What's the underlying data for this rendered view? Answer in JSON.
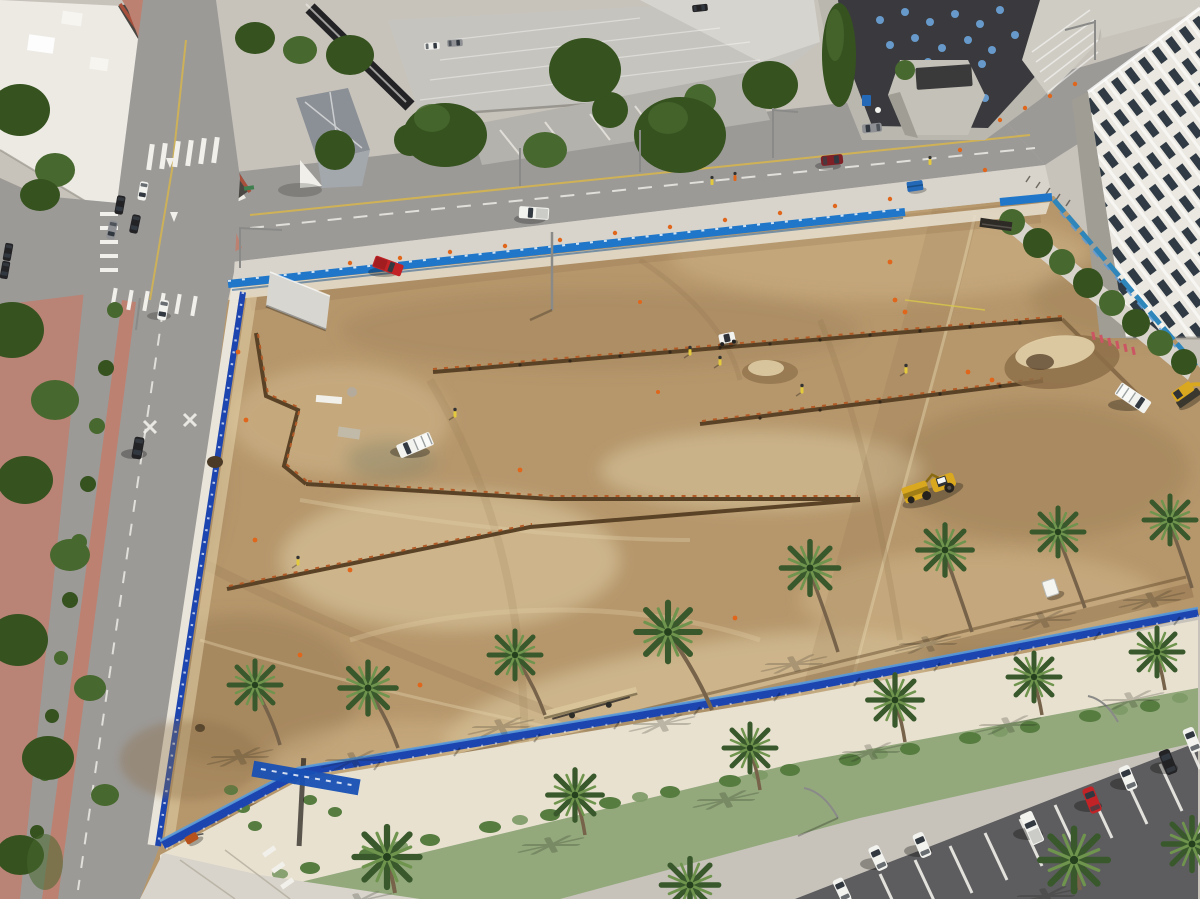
{
  "palette": {
    "dirt": "#b6976c",
    "dirtLight": "#d2b88c",
    "dirtPale": "#e3d2aa",
    "dirtDark": "#8d6f49",
    "asphalt": "#9c9a97",
    "lotAsphalt": "#5d5d5f",
    "concrete": "#c7c3bb",
    "concreteBright": "#e5dfd1",
    "plazaLight": "#d8d4cb",
    "walkSand": "#e8e1d0",
    "brick": "#bd8172",
    "roofWhite": "#eceae3",
    "trimRed": "#a8503c",
    "windowDark": "#4a4742",
    "garageGray": "#c6c4be",
    "garageLight": "#d6d4ce",
    "civicRoof": "#3a3a3e",
    "civicConcrete": "#bab7af",
    "towerGray": "#c4c1b8",
    "skylight": "#6ba3d6",
    "whiteBldg": "#eae8e1",
    "whiteBldgShade": "#a09d94",
    "winNavy": "#303a44",
    "stairGray": "#cfccc3",
    "houseRoof": "#8b9096",
    "houseRoofLight": "#a3a8ad",
    "awning": "#232326",
    "treeDark": "#35521f",
    "treeMid": "#47682e",
    "treeLight": "#5d8440",
    "palmDark": "#39592c",
    "palmLight": "#6f944d",
    "trunk": "#77624a",
    "shrub": "#7d9a66",
    "shrubDark": "#567c40",
    "plantBase": "#93a97c",
    "fenceTop": "#2077c9",
    "fenceRoyal": "#1d45b0",
    "fenceTeal": "#2f86ba",
    "fenceLite": "#5b9bd9",
    "kRail": "#e9e5da",
    "coneOrange": "#e0661c",
    "formRust": "#b35b27",
    "trenchBrown": "#5a4226",
    "machineYellow": "#d9a81f",
    "machineDark": "#8a6a10",
    "vehRed": "#c22327",
    "vehDarkRed": "#7e2026",
    "vehWhite": "#f2f2ef",
    "vehBlack": "#232326",
    "vehGray": "#8e9094",
    "yellowLine": "#d9b64a",
    "whiteMark": "#f2f0ea",
    "safety": "#e3c93c",
    "binPink": "#cb5562",
    "lumber": "#d9c49a",
    "toiletWhite": "#f4f4f0",
    "bannerBlue": "#1850b4",
    "signGreen": "#3f7f4f",
    "poleGray": "#8a8a88"
  },
  "scene": {
    "type": "aerial-drone-photo",
    "subject": "graded dirt construction site in a downtown block, sunny day",
    "areas": [
      "graded-dirt-construction-site",
      "west-street-with-brick-median",
      "north-street",
      "city-intersection-northwest",
      "parking-garage-north",
      "historic-house-north",
      "civic-building-with-round-skylights",
      "white-office-tower-northeast",
      "palm-lined-promenade-south",
      "angled-parking-lot-southeast"
    ],
    "fences": {
      "north": "light-blue construction panels with white logos",
      "west": "blue panels behind white k-rail along street",
      "east": "teal-blue banners on chain link with young trees",
      "south": "royal-blue screen fence"
    },
    "vehicles": [
      {
        "type": "pickup-truck",
        "color": "red",
        "area": "site-north"
      },
      {
        "type": "utility-truck",
        "color": "white",
        "area": "site-center"
      },
      {
        "type": "bucket-truck",
        "color": "white",
        "area": "site-east"
      },
      {
        "type": "wheel-scraper",
        "color": "yellow",
        "area": "site-center-south"
      },
      {
        "type": "skid-steer",
        "color": "white",
        "area": "site-center"
      },
      {
        "type": "excavator",
        "color": "yellow",
        "area": "site-east-edge"
      },
      {
        "type": "sedan",
        "color": "black",
        "area": "west-street"
      },
      {
        "type": "sedan",
        "color": "white",
        "area": "west-street"
      },
      {
        "type": "pickup-truck",
        "color": "white",
        "area": "north-street"
      },
      {
        "type": "sedan",
        "color": "dark-red",
        "area": "north-street"
      },
      {
        "type": "parked-cars",
        "colors": [
          "white",
          "white",
          "white",
          "red",
          "white",
          "dark-gray",
          "white"
        ],
        "area": "parking-lot-southeast"
      }
    ],
    "counts": {
      "palm_trees": 17,
      "construction_workers": 9,
      "parked_cars_bottom_right": 7
    }
  }
}
